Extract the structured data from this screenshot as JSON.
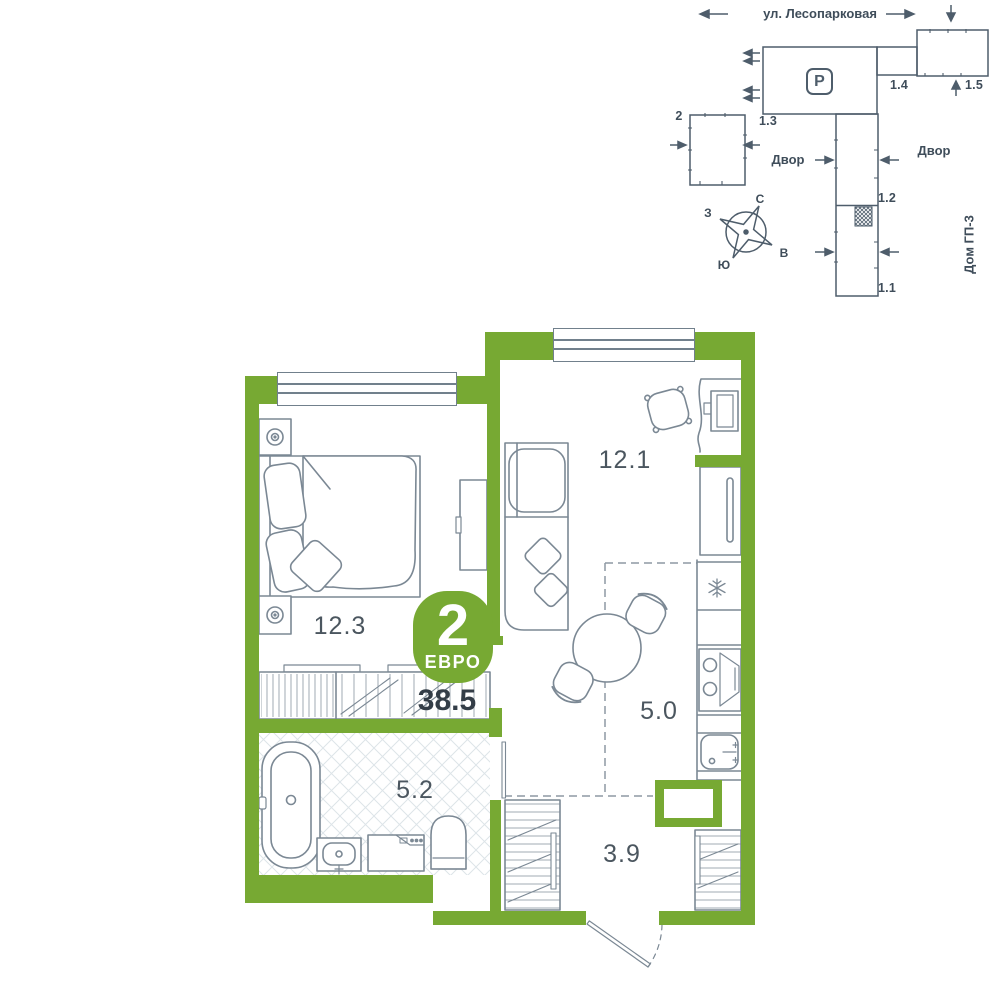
{
  "colors": {
    "wall_green": "#77a933",
    "plan_line": "#4e5d6b",
    "furniture_line": "#7b8894",
    "label_text": "#4b565f",
    "area_text": "#333d47"
  },
  "site_plan": {
    "street": "ул. Лесопарковая",
    "yard_left": "Двор",
    "yard_right": "Двор",
    "neighbor_house": "Дом ГП-3",
    "parking_letter": "P",
    "buildings": {
      "b2": "2",
      "b13": "1.3",
      "b14": "1.4",
      "b15": "1.5",
      "b12": "1.2",
      "b11": "1.1"
    },
    "compass": {
      "north": "С",
      "south": "Ю",
      "west": "З",
      "east": "В"
    }
  },
  "apartment": {
    "badge": {
      "rooms": "2",
      "type": "ЕВРО"
    },
    "total_area": "38.5",
    "rooms": [
      {
        "name": "bedroom",
        "area": "12.3"
      },
      {
        "name": "living-room",
        "area": "12.1"
      },
      {
        "name": "kitchen",
        "area": "5.0"
      },
      {
        "name": "bathroom",
        "area": "5.2"
      },
      {
        "name": "hallway",
        "area": "3.9"
      }
    ]
  }
}
